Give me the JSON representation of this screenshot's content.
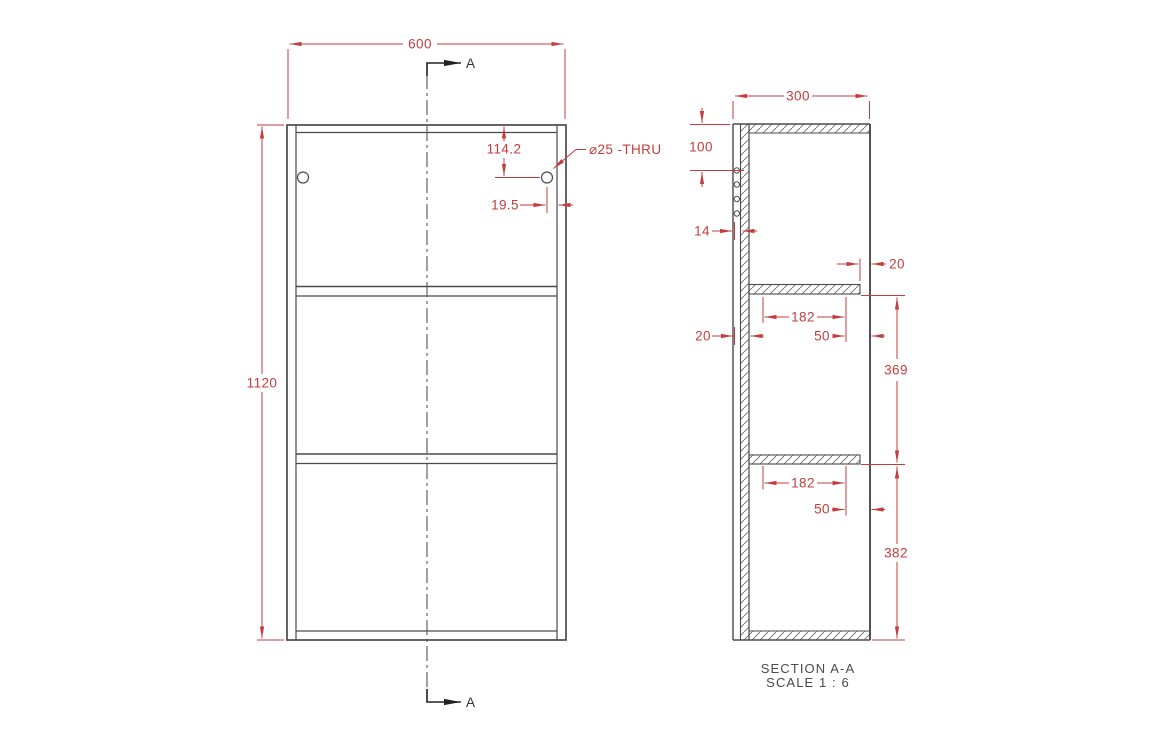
{
  "front_view": {
    "width": "600",
    "height": "1120",
    "hole_top_offset": "114.2",
    "hole_side_offset": "19.5",
    "hole_callout": "⌀25 -THRU",
    "section_arrow_top": "A",
    "section_arrow_bottom": "A"
  },
  "section_view": {
    "depth": "300",
    "hole_top_offset": "100",
    "hole_depth": "14",
    "panel_thickness": "20",
    "shelf1": {
      "rear_gap": "20",
      "pin_spacing": "182",
      "front_gap": "50"
    },
    "shelf_gap": "369",
    "shelf2": {
      "pin_spacing": "182",
      "front_gap": "50"
    },
    "bottom_gap": "382",
    "caption": "SECTION A-A",
    "scale": "SCALE 1 : 6"
  },
  "colors": {
    "dimension_red": "#c43c3c",
    "drawing_gray": "#4a4a4a"
  }
}
